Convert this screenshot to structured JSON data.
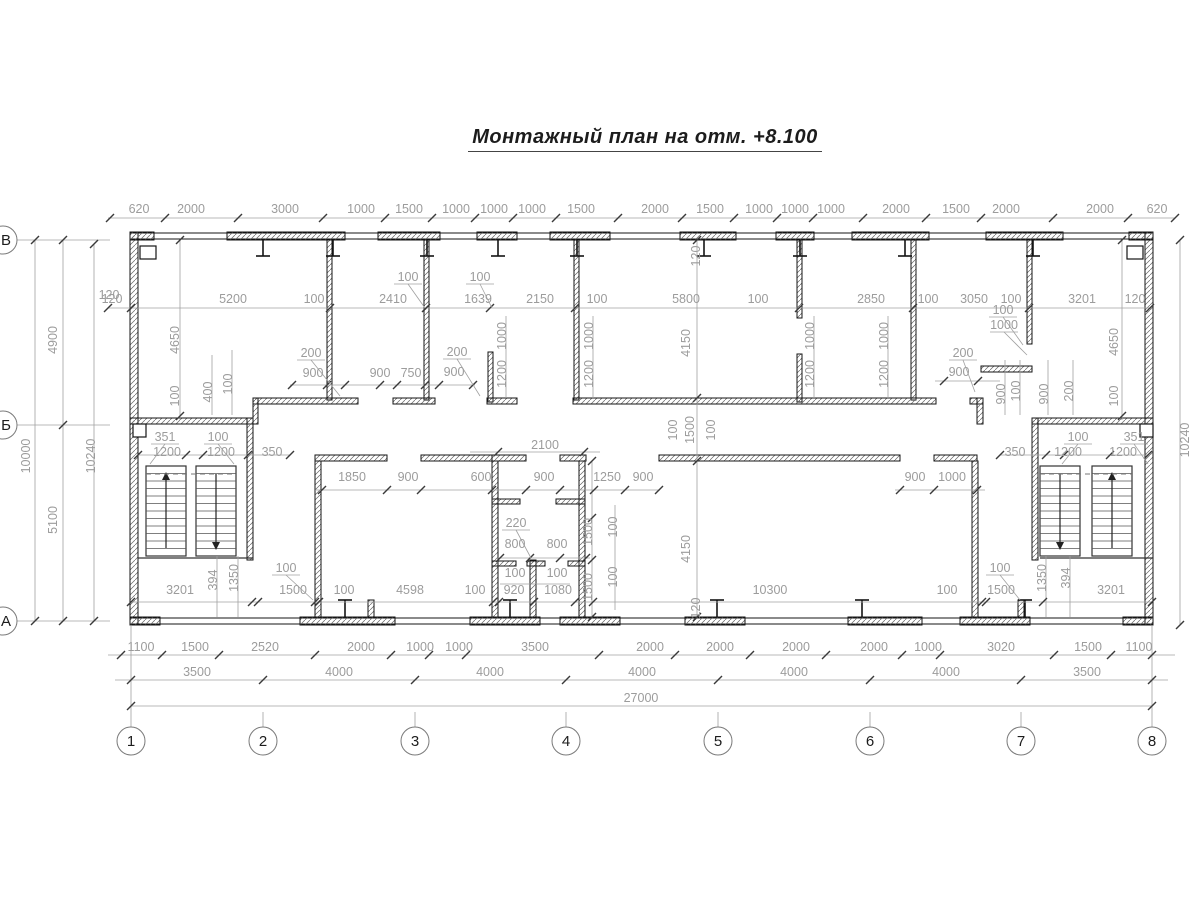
{
  "title": "Монтажный план на отм. +8.100",
  "colors": {
    "wall": "#141414",
    "dim_text": "#9c9c9c",
    "dim_line": "#a0a0a0",
    "tick": "#3a3a3a"
  },
  "axes": {
    "bottom": [
      {
        "label": "1",
        "x": 131
      },
      {
        "label": "2",
        "x": 263
      },
      {
        "label": "3",
        "x": 415
      },
      {
        "label": "4",
        "x": 566
      },
      {
        "label": "5",
        "x": 718
      },
      {
        "label": "6",
        "x": 870
      },
      {
        "label": "7",
        "x": 1021
      },
      {
        "label": "8",
        "x": 1152
      }
    ],
    "left": [
      {
        "label": "В",
        "y": 240
      },
      {
        "label": "Б",
        "y": 425
      },
      {
        "label": "А",
        "y": 621
      }
    ]
  },
  "dim_labels": [
    {
      "t": "620",
      "x": 139,
      "y": 213
    },
    {
      "t": "2000",
      "x": 191,
      "y": 213
    },
    {
      "t": "3000",
      "x": 285,
      "y": 213
    },
    {
      "t": "1000",
      "x": 361,
      "y": 213
    },
    {
      "t": "1500",
      "x": 409,
      "y": 213
    },
    {
      "t": "1000",
      "x": 456,
      "y": 213
    },
    {
      "t": "1000",
      "x": 494,
      "y": 213
    },
    {
      "t": "1000",
      "x": 532,
      "y": 213
    },
    {
      "t": "1500",
      "x": 581,
      "y": 213
    },
    {
      "t": "2000",
      "x": 655,
      "y": 213
    },
    {
      "t": "1500",
      "x": 710,
      "y": 213
    },
    {
      "t": "1000",
      "x": 759,
      "y": 213
    },
    {
      "t": "1000",
      "x": 795,
      "y": 213
    },
    {
      "t": "1000",
      "x": 831,
      "y": 213
    },
    {
      "t": "2000",
      "x": 896,
      "y": 213
    },
    {
      "t": "1500",
      "x": 956,
      "y": 213
    },
    {
      "t": "2000",
      "x": 1006,
      "y": 213
    },
    {
      "t": "2000",
      "x": 1100,
      "y": 213
    },
    {
      "t": "620",
      "x": 1157,
      "y": 213
    },
    {
      "t": "120",
      "x": 112,
      "y": 303
    },
    {
      "t": "5200",
      "x": 233,
      "y": 303
    },
    {
      "t": "100",
      "x": 314,
      "y": 303
    },
    {
      "t": "2410",
      "x": 393,
      "y": 303
    },
    {
      "t": "1639",
      "x": 478,
      "y": 303
    },
    {
      "t": "2150",
      "x": 540,
      "y": 303
    },
    {
      "t": "100",
      "x": 597,
      "y": 303
    },
    {
      "t": "5800",
      "x": 686,
      "y": 303
    },
    {
      "t": "100",
      "x": 758,
      "y": 303
    },
    {
      "t": "2850",
      "x": 871,
      "y": 303
    },
    {
      "t": "100",
      "x": 928,
      "y": 303
    },
    {
      "t": "3050",
      "x": 974,
      "y": 303
    },
    {
      "t": "100",
      "x": 1011,
      "y": 303
    },
    {
      "t": "3201",
      "x": 1082,
      "y": 303
    },
    {
      "t": "120",
      "x": 1135,
      "y": 303
    },
    {
      "t": "100",
      "x": 408,
      "y": 281
    },
    {
      "t": "100",
      "x": 480,
      "y": 281
    },
    {
      "t": "100",
      "x": 1003,
      "y": 314
    },
    {
      "t": "1000",
      "x": 1004,
      "y": 329
    },
    {
      "t": "4650",
      "x": 179,
      "y": 340,
      "r": -90
    },
    {
      "t": "100",
      "x": 179,
      "y": 396,
      "r": -90
    },
    {
      "t": "400",
      "x": 212,
      "y": 392,
      "r": -90
    },
    {
      "t": "100",
      "x": 232,
      "y": 384,
      "r": -90
    },
    {
      "t": "4650",
      "x": 1118,
      "y": 342,
      "r": -90
    },
    {
      "t": "100",
      "x": 1118,
      "y": 396,
      "r": -90
    },
    {
      "t": "1000",
      "x": 506,
      "y": 336,
      "r": -90
    },
    {
      "t": "1200",
      "x": 506,
      "y": 374,
      "r": -90
    },
    {
      "t": "1000",
      "x": 593,
      "y": 336,
      "r": -90
    },
    {
      "t": "1200",
      "x": 593,
      "y": 374,
      "r": -90
    },
    {
      "t": "1000",
      "x": 814,
      "y": 336,
      "r": -90
    },
    {
      "t": "1200",
      "x": 814,
      "y": 374,
      "r": -90
    },
    {
      "t": "1000",
      "x": 888,
      "y": 336,
      "r": -90
    },
    {
      "t": "1200",
      "x": 888,
      "y": 374,
      "r": -90
    },
    {
      "t": "120",
      "x": 700,
      "y": 256,
      "r": -90
    },
    {
      "t": "4150",
      "x": 690,
      "y": 343,
      "r": -90
    },
    {
      "t": "100",
      "x": 677,
      "y": 430,
      "r": -90
    },
    {
      "t": "1500",
      "x": 694,
      "y": 430,
      "r": -90
    },
    {
      "t": "100",
      "x": 715,
      "y": 430,
      "r": -90
    },
    {
      "t": "4150",
      "x": 690,
      "y": 549,
      "r": -90
    },
    {
      "t": "120",
      "x": 700,
      "y": 608,
      "r": -90
    },
    {
      "t": "900",
      "x": 1005,
      "y": 394,
      "r": -90
    },
    {
      "t": "100",
      "x": 1020,
      "y": 391,
      "r": -90
    },
    {
      "t": "900",
      "x": 1048,
      "y": 394,
      "r": -90
    },
    {
      "t": "200",
      "x": 1073,
      "y": 391,
      "r": -90
    },
    {
      "t": "200",
      "x": 311,
      "y": 357
    },
    {
      "t": "900",
      "x": 313,
      "y": 377
    },
    {
      "t": "900",
      "x": 380,
      "y": 377
    },
    {
      "t": "750",
      "x": 411,
      "y": 377
    },
    {
      "t": "200",
      "x": 457,
      "y": 356
    },
    {
      "t": "900",
      "x": 454,
      "y": 376
    },
    {
      "t": "200",
      "x": 963,
      "y": 357
    },
    {
      "t": "900",
      "x": 959,
      "y": 376
    },
    {
      "t": "10000",
      "x": 30,
      "y": 456,
      "r": -90
    },
    {
      "t": "4900",
      "x": 57,
      "y": 340,
      "r": -90
    },
    {
      "t": "5100",
      "x": 57,
      "y": 520,
      "r": -90
    },
    {
      "t": "10240",
      "x": 95,
      "y": 456,
      "r": -90
    },
    {
      "t": "120",
      "x": 109,
      "y": 299
    },
    {
      "t": "10240",
      "x": 1189,
      "y": 440,
      "r": -90
    },
    {
      "t": "351",
      "x": 165,
      "y": 441
    },
    {
      "t": "100",
      "x": 218,
      "y": 441
    },
    {
      "t": "1200",
      "x": 167,
      "y": 456
    },
    {
      "t": "1200",
      "x": 221,
      "y": 456
    },
    {
      "t": "350",
      "x": 272,
      "y": 456
    },
    {
      "t": "350",
      "x": 1015,
      "y": 456
    },
    {
      "t": "100",
      "x": 1078,
      "y": 441
    },
    {
      "t": "351",
      "x": 1134,
      "y": 441
    },
    {
      "t": "1200",
      "x": 1068,
      "y": 456
    },
    {
      "t": "1200",
      "x": 1123,
      "y": 456
    },
    {
      "t": "2100",
      "x": 545,
      "y": 449
    },
    {
      "t": "1850",
      "x": 352,
      "y": 481
    },
    {
      "t": "900",
      "x": 408,
      "y": 481
    },
    {
      "t": "600",
      "x": 481,
      "y": 481
    },
    {
      "t": "900",
      "x": 544,
      "y": 481
    },
    {
      "t": "1250",
      "x": 607,
      "y": 481
    },
    {
      "t": "900",
      "x": 643,
      "y": 481
    },
    {
      "t": "900",
      "x": 915,
      "y": 481
    },
    {
      "t": "1000",
      "x": 952,
      "y": 481
    },
    {
      "t": "220",
      "x": 516,
      "y": 527
    },
    {
      "t": "800",
      "x": 515,
      "y": 548
    },
    {
      "t": "800",
      "x": 557,
      "y": 548
    },
    {
      "t": "100",
      "x": 515,
      "y": 577
    },
    {
      "t": "100",
      "x": 557,
      "y": 577
    },
    {
      "t": "100",
      "x": 475,
      "y": 594
    },
    {
      "t": "920",
      "x": 514,
      "y": 594
    },
    {
      "t": "1080",
      "x": 558,
      "y": 594
    },
    {
      "t": "1500",
      "x": 592,
      "y": 532,
      "r": -90
    },
    {
      "t": "100",
      "x": 617,
      "y": 527,
      "r": -90
    },
    {
      "t": "1500",
      "x": 592,
      "y": 587,
      "r": -90
    },
    {
      "t": "100",
      "x": 617,
      "y": 577,
      "r": -90
    },
    {
      "t": "3201",
      "x": 180,
      "y": 594
    },
    {
      "t": "394",
      "x": 217,
      "y": 580,
      "r": -90
    },
    {
      "t": "1350",
      "x": 238,
      "y": 578,
      "r": -90
    },
    {
      "t": "100",
      "x": 286,
      "y": 572
    },
    {
      "t": "1500",
      "x": 293,
      "y": 594
    },
    {
      "t": "100",
      "x": 344,
      "y": 594
    },
    {
      "t": "4598",
      "x": 410,
      "y": 594
    },
    {
      "t": "10300",
      "x": 770,
      "y": 594
    },
    {
      "t": "100",
      "x": 947,
      "y": 594
    },
    {
      "t": "1500",
      "x": 1001,
      "y": 594
    },
    {
      "t": "100",
      "x": 1000,
      "y": 572
    },
    {
      "t": "1350",
      "x": 1046,
      "y": 578,
      "r": -90
    },
    {
      "t": "394",
      "x": 1070,
      "y": 578,
      "r": -90
    },
    {
      "t": "3201",
      "x": 1111,
      "y": 594
    },
    {
      "t": "1100",
      "x": 141,
      "y": 651
    },
    {
      "t": "1500",
      "x": 195,
      "y": 651
    },
    {
      "t": "2520",
      "x": 265,
      "y": 651
    },
    {
      "t": "2000",
      "x": 361,
      "y": 651
    },
    {
      "t": "1000",
      "x": 420,
      "y": 651
    },
    {
      "t": "1000",
      "x": 459,
      "y": 651
    },
    {
      "t": "3500",
      "x": 535,
      "y": 651
    },
    {
      "t": "2000",
      "x": 650,
      "y": 651
    },
    {
      "t": "2000",
      "x": 720,
      "y": 651
    },
    {
      "t": "2000",
      "x": 796,
      "y": 651
    },
    {
      "t": "2000",
      "x": 874,
      "y": 651
    },
    {
      "t": "1000",
      "x": 928,
      "y": 651
    },
    {
      "t": "3020",
      "x": 1001,
      "y": 651
    },
    {
      "t": "1500",
      "x": 1088,
      "y": 651
    },
    {
      "t": "1100",
      "x": 1139,
      "y": 651
    },
    {
      "t": "3500",
      "x": 197,
      "y": 676
    },
    {
      "t": "4000",
      "x": 339,
      "y": 676
    },
    {
      "t": "4000",
      "x": 490,
      "y": 676
    },
    {
      "t": "4000",
      "x": 642,
      "y": 676
    },
    {
      "t": "4000",
      "x": 794,
      "y": 676
    },
    {
      "t": "4000",
      "x": 946,
      "y": 676
    },
    {
      "t": "3500",
      "x": 1087,
      "y": 676
    },
    {
      "t": "27000",
      "x": 641,
      "y": 702
    }
  ]
}
